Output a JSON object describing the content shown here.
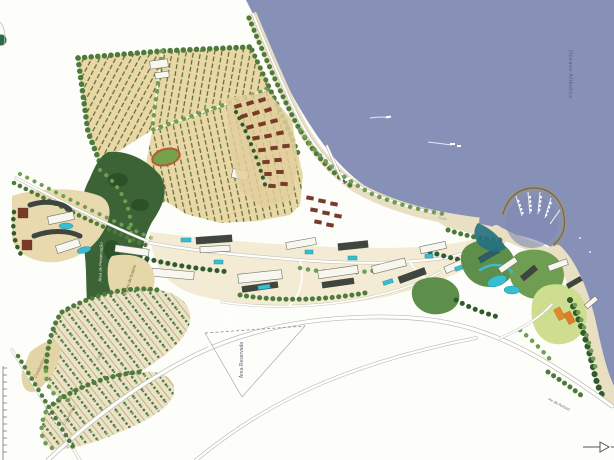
{
  "map": {
    "labels": {
      "ocean": "Oceano Atlântico",
      "preservation": "Área de Preservação",
      "nucleo": "Núcleo de Ensino",
      "condominio_upper": "Condomínio",
      "condominio_lower": "Condomínio",
      "vilas": "Vilas",
      "area_reservada": "Área Reservada",
      "road": "Av. de Acesso",
      "beach": "Praia"
    },
    "colors": {
      "water": "#8791b8",
      "sand": "#e9dfc2",
      "orchard": "#e9d8a6",
      "field": "#e7dbb4",
      "forest": "#3b6336",
      "lawn": "#cfdd90",
      "pool": "#39bdd1",
      "channel": "#23707f",
      "breakwater": "#9a9283"
    }
  }
}
